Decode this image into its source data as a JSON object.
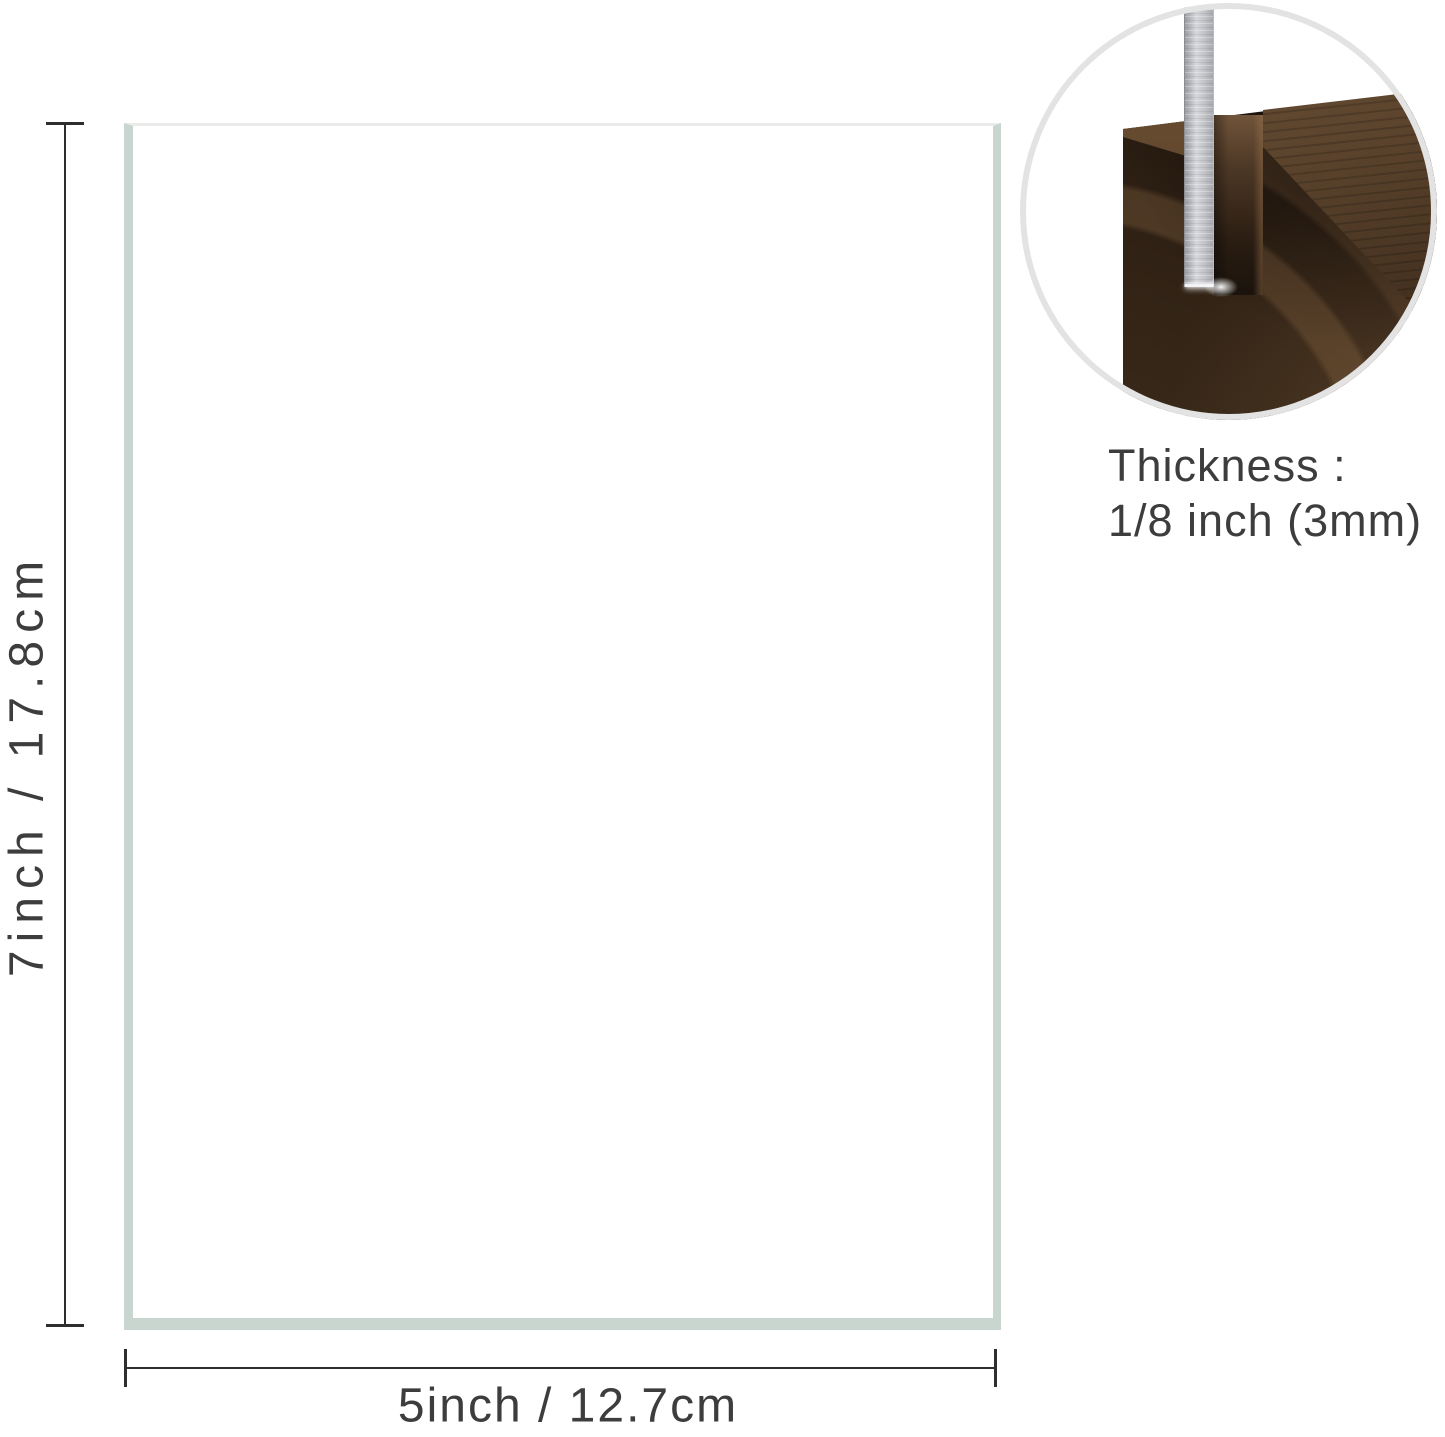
{
  "diagram": {
    "sheet": {
      "height_label": "7inch / 17.8cm",
      "width_label": "5inch / 12.7cm"
    },
    "inset": {
      "caption_title": "Thickness :",
      "caption_value": "1/8 inch (3mm)"
    }
  },
  "colors": {
    "text": "#3d3d3d",
    "line": "#2e2e2e",
    "sheet_fill": "#ffffff",
    "sheet_edge": "#c9d5cf",
    "sheet_edge_top": "#eaecea",
    "circle_ring": "#e3e3e3",
    "wood_dark": "#241a10",
    "wood_light": "#6f5234",
    "acrylic": "#c6c7cb"
  }
}
